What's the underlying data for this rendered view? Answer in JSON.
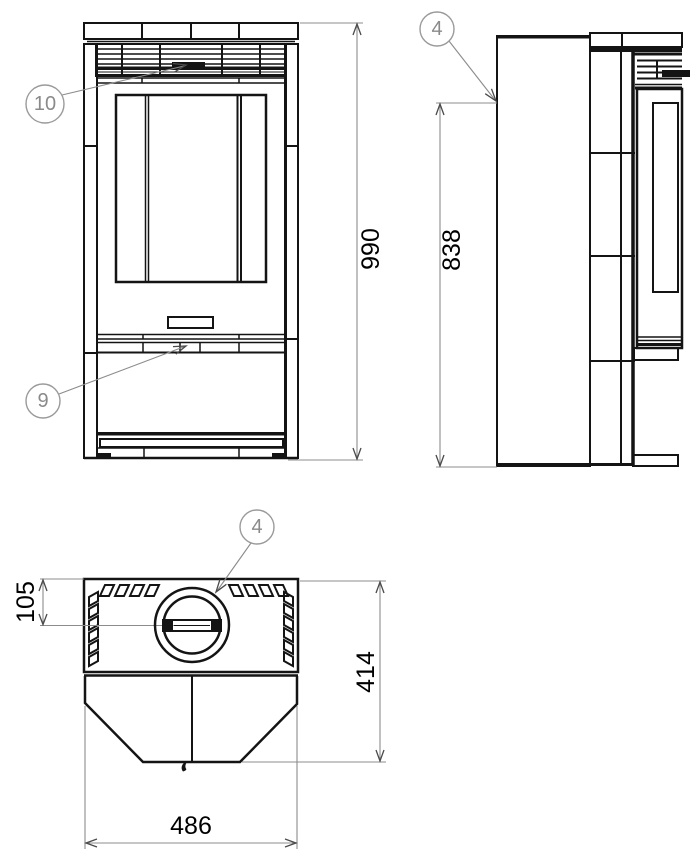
{
  "drawing": {
    "title": "stove-three-view-technical-drawing",
    "colors": {
      "background": "#ffffff",
      "outline": "#141414",
      "annotation": "#8c8c8c",
      "dimension_text": "#000000",
      "balloon_text": "#8a8a8a"
    },
    "dimensions": {
      "front_height": "990",
      "body_height": "838",
      "flue_center_offset": "105",
      "depth": "414",
      "width": "486"
    },
    "balloons": {
      "top_grille": "10",
      "front_trim": "9",
      "side_panel": "4",
      "flue_collar": "4"
    }
  }
}
